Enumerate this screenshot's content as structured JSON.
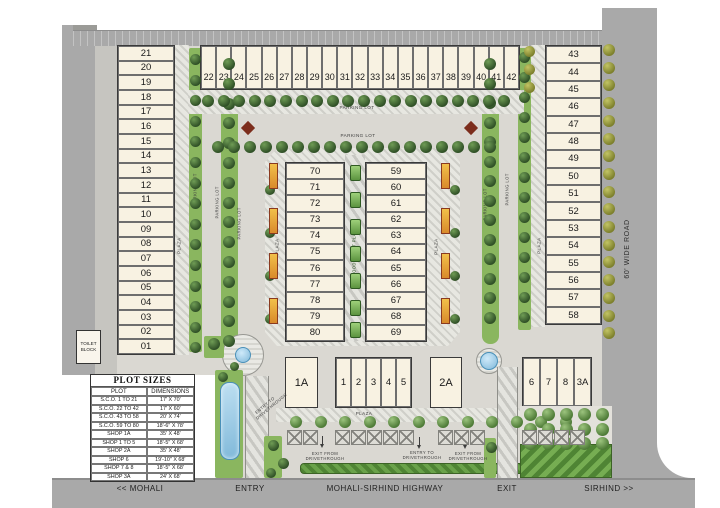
{
  "plots": {
    "left": [
      "21",
      "20",
      "19",
      "18",
      "17",
      "16",
      "15",
      "14",
      "13",
      "12",
      "11",
      "10",
      "09",
      "08",
      "07",
      "06",
      "05",
      "04",
      "03",
      "02",
      "01"
    ],
    "top": [
      "22",
      "23",
      "24",
      "25",
      "26",
      "27",
      "28",
      "29",
      "30",
      "31",
      "32",
      "33",
      "34",
      "35",
      "36",
      "37",
      "38",
      "39",
      "40",
      "41",
      "42"
    ],
    "right": [
      "43",
      "44",
      "45",
      "46",
      "47",
      "48",
      "49",
      "50",
      "51",
      "52",
      "53",
      "54",
      "55",
      "56",
      "57",
      "58"
    ],
    "center_west": [
      "70",
      "71",
      "72",
      "73",
      "74",
      "75",
      "76",
      "77",
      "78",
      "79",
      "80"
    ],
    "center_east": [
      "59",
      "60",
      "61",
      "62",
      "63",
      "64",
      "65",
      "66",
      "67",
      "68",
      "69"
    ],
    "shop_1a": "1A",
    "shops_mid": [
      "1",
      "2",
      "3",
      "4",
      "5"
    ],
    "shop_2a": "2A",
    "shops_east": [
      "6",
      "7",
      "8",
      "3A"
    ]
  },
  "labels": {
    "toilet_block": "TOILET BLOCK",
    "parking_lot": "PARKING LOT",
    "plaza": "PLAZA",
    "food_court_plaza": "FOOD COURT PLAZA",
    "wide_road": "60' WIDE ROAD",
    "entry_to_drivethrough": "ENTRY TO DRIVETHROUGH",
    "exit_from_drivethrough": "EXIT FROM DRIVETHROUGH"
  },
  "highway": {
    "mohali": "<< MOHALI",
    "entry": "ENTRY",
    "highway_name": "MOHALI-SIRHIND HIGHWAY",
    "exit": "EXIT",
    "sirhind": "SIRHIND >>"
  },
  "plot_table": {
    "title": "PLOT SIZES",
    "headers": [
      "PLOT",
      "DIMENSIONS"
    ],
    "rows": [
      [
        "S.C.O. 1 TO 21",
        "17' X 70'"
      ],
      [
        "S.C.O. 22 TO 42",
        "17' X 60'"
      ],
      [
        "S.C.O. 43 TO 58",
        "20' X 74'"
      ],
      [
        "S.C.O. 59 TO 80",
        "18'-6\" X 78'"
      ],
      [
        "SHOP 1A",
        "35' X 48'"
      ],
      [
        "SHOP 1 TO 5",
        "18'-5\" X 68'"
      ],
      [
        "SHOP 2A",
        "35' X 48'"
      ],
      [
        "SHOP 6",
        "19'-10\" X 68'"
      ],
      [
        "SHOP 7 & 8",
        "18'-5\" X 68'"
      ],
      [
        "SHOP 3A",
        "24' X 68'"
      ]
    ]
  },
  "colors": {
    "plot_fill": "#f8f2e2",
    "road_gray": "#a9a9a9",
    "green_strip": "#8ab65f",
    "tree_dark": "#2f4f26",
    "tree_olive": "#7c7f2c",
    "water_blue": "#8ec6e8",
    "kiosk_orange": "#d98a2b",
    "hedge_green": "#4f8434"
  }
}
